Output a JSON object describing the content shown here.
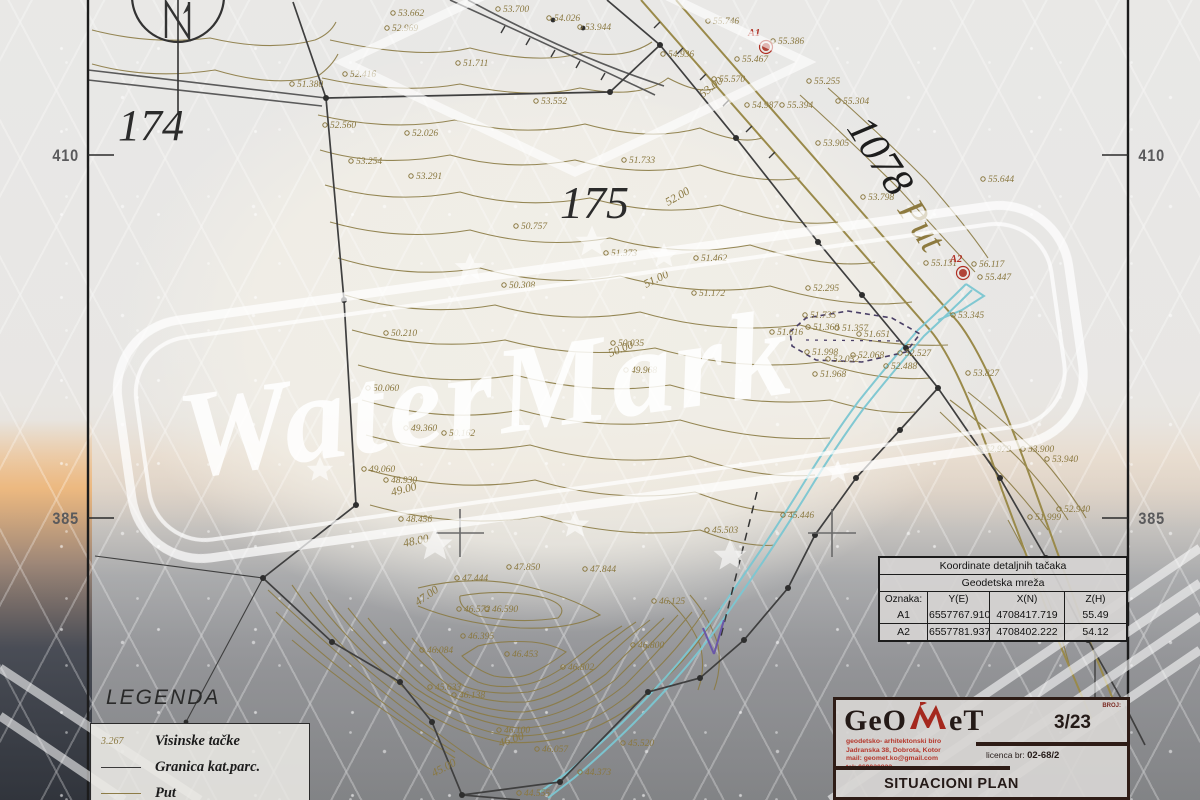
{
  "watermark": {
    "text": "WaterMark"
  },
  "colors": {
    "olive": "#8d7c46",
    "boundary": "#3f3f3f",
    "stream": "#7cc7d2",
    "purple": "#5a4a7a",
    "red": "#b03024",
    "logo_red": "#a5281e"
  },
  "frame": {
    "edge_labels": [
      {
        "text": "410",
        "x": 50,
        "y": 146
      },
      {
        "text": "385",
        "x": 50,
        "y": 509
      },
      {
        "text": "410",
        "x": 1136,
        "y": 146
      },
      {
        "text": "385",
        "x": 1136,
        "y": 509
      }
    ]
  },
  "map": {
    "area_labels": [
      {
        "text": "174",
        "x": 118,
        "y": 140,
        "size": 44,
        "rot": 0,
        "color": "#2b2b2b"
      },
      {
        "text": "175",
        "x": 560,
        "y": 218,
        "size": 46,
        "rot": 0,
        "color": "#2b2b2b"
      },
      {
        "text": "1078",
        "x": 846,
        "y": 128,
        "size": 42,
        "rot": 57,
        "color": "#1d1d1d"
      },
      {
        "text": "Put",
        "x": 897,
        "y": 210,
        "size": 38,
        "rot": 57,
        "color": "#8d7a3f"
      }
    ],
    "control_points": [
      {
        "name": "A1",
        "x": 766,
        "y": 47,
        "tx": 748,
        "ty": 36
      },
      {
        "name": "A2",
        "x": 963,
        "y": 273,
        "tx": 950,
        "ty": 262
      }
    ],
    "contour_labels": [
      {
        "v": "53.00",
        "x": 703,
        "y": 98,
        "r": -38
      },
      {
        "v": "52.00",
        "x": 668,
        "y": 206,
        "r": -30
      },
      {
        "v": "51.00",
        "x": 646,
        "y": 288,
        "r": -26
      },
      {
        "v": "50.00",
        "x": 610,
        "y": 357,
        "r": -22
      },
      {
        "v": "49.00",
        "x": 392,
        "y": 496,
        "r": -14
      },
      {
        "v": "48.00",
        "x": 404,
        "y": 547,
        "r": -12
      },
      {
        "v": "47.00",
        "x": 418,
        "y": 606,
        "r": -35
      },
      {
        "v": "46.00",
        "x": 500,
        "y": 747,
        "r": -18
      },
      {
        "v": "45.00",
        "x": 434,
        "y": 777,
        "r": -28
      }
    ],
    "spot_heights": [
      {
        "v": "53.662",
        "x": 398,
        "y": 16
      },
      {
        "v": "52.969",
        "x": 392,
        "y": 31
      },
      {
        "v": "53.700",
        "x": 503,
        "y": 12
      },
      {
        "v": "54.026",
        "x": 554,
        "y": 21
      },
      {
        "v": "53.944",
        "x": 585,
        "y": 30
      },
      {
        "v": "54.936",
        "x": 668,
        "y": 57
      },
      {
        "v": "55.746",
        "x": 713,
        "y": 24
      },
      {
        "v": "55.570",
        "x": 719,
        "y": 82
      },
      {
        "v": "55.467",
        "x": 742,
        "y": 62
      },
      {
        "v": "55.386",
        "x": 778,
        "y": 44
      },
      {
        "v": "55.255",
        "x": 814,
        "y": 84
      },
      {
        "v": "55.394",
        "x": 787,
        "y": 108
      },
      {
        "v": "54.987",
        "x": 752,
        "y": 108
      },
      {
        "v": "55.304",
        "x": 843,
        "y": 104
      },
      {
        "v": "53.905",
        "x": 823,
        "y": 146
      },
      {
        "v": "53.798",
        "x": 868,
        "y": 200
      },
      {
        "v": "55.644",
        "x": 988,
        "y": 182
      },
      {
        "v": "51.380",
        "x": 297,
        "y": 87
      },
      {
        "v": "52.416",
        "x": 350,
        "y": 77
      },
      {
        "v": "51.711",
        "x": 463,
        "y": 66
      },
      {
        "v": "53.552",
        "x": 541,
        "y": 104
      },
      {
        "v": "52.560",
        "x": 330,
        "y": 128
      },
      {
        "v": "52.026",
        "x": 412,
        "y": 136
      },
      {
        "v": "53.254",
        "x": 356,
        "y": 164
      },
      {
        "v": "53.291",
        "x": 416,
        "y": 179
      },
      {
        "v": "51.733",
        "x": 629,
        "y": 163
      },
      {
        "v": "50.757",
        "x": 521,
        "y": 229
      },
      {
        "v": "51.373",
        "x": 611,
        "y": 256
      },
      {
        "v": "51.462",
        "x": 701,
        "y": 261
      },
      {
        "v": "50.308",
        "x": 509,
        "y": 288
      },
      {
        "v": "51.172",
        "x": 699,
        "y": 296
      },
      {
        "v": "50.210",
        "x": 391,
        "y": 336
      },
      {
        "v": "50.035",
        "x": 618,
        "y": 346
      },
      {
        "v": "49.968",
        "x": 631,
        "y": 373
      },
      {
        "v": "50.060",
        "x": 373,
        "y": 391
      },
      {
        "v": "50.162",
        "x": 449,
        "y": 436
      },
      {
        "v": "49.360",
        "x": 411,
        "y": 431
      },
      {
        "v": "49.060",
        "x": 369,
        "y": 472
      },
      {
        "v": "48.930",
        "x": 391,
        "y": 483
      },
      {
        "v": "48.456",
        "x": 406,
        "y": 522
      },
      {
        "v": "52.295",
        "x": 813,
        "y": 291
      },
      {
        "v": "51.616",
        "x": 777,
        "y": 335
      },
      {
        "v": "51.735",
        "x": 810,
        "y": 318
      },
      {
        "v": "51.360",
        "x": 813,
        "y": 330
      },
      {
        "v": "51.357",
        "x": 842,
        "y": 331
      },
      {
        "v": "51.651",
        "x": 864,
        "y": 337
      },
      {
        "v": "51.998",
        "x": 812,
        "y": 355
      },
      {
        "v": "52.052",
        "x": 833,
        "y": 362
      },
      {
        "v": "52.068",
        "x": 858,
        "y": 358
      },
      {
        "v": "51.968",
        "x": 820,
        "y": 377
      },
      {
        "v": "52.527",
        "x": 905,
        "y": 356
      },
      {
        "v": "52.488",
        "x": 891,
        "y": 369
      },
      {
        "v": "55.131",
        "x": 931,
        "y": 266
      },
      {
        "v": "56.117",
        "x": 979,
        "y": 267
      },
      {
        "v": "55.447",
        "x": 985,
        "y": 280
      },
      {
        "v": "53.345",
        "x": 958,
        "y": 318
      },
      {
        "v": "53.827",
        "x": 973,
        "y": 376
      },
      {
        "v": "52.979",
        "x": 985,
        "y": 452
      },
      {
        "v": "53.900",
        "x": 1028,
        "y": 452
      },
      {
        "v": "53.940",
        "x": 1052,
        "y": 462
      },
      {
        "v": "51.999",
        "x": 1035,
        "y": 520
      },
      {
        "v": "52.940",
        "x": 1064,
        "y": 512
      },
      {
        "v": "45.446",
        "x": 788,
        "y": 518
      },
      {
        "v": "45.503",
        "x": 712,
        "y": 533
      },
      {
        "v": "47.850",
        "x": 514,
        "y": 570
      },
      {
        "v": "47.844",
        "x": 590,
        "y": 572
      },
      {
        "v": "47.444",
        "x": 462,
        "y": 581
      },
      {
        "v": "46.572",
        "x": 464,
        "y": 612
      },
      {
        "v": "46.590",
        "x": 492,
        "y": 612
      },
      {
        "v": "46.125",
        "x": 659,
        "y": 604
      },
      {
        "v": "46.395",
        "x": 468,
        "y": 639
      },
      {
        "v": "46.084",
        "x": 427,
        "y": 653
      },
      {
        "v": "46.453",
        "x": 512,
        "y": 657
      },
      {
        "v": "46.802",
        "x": 568,
        "y": 670
      },
      {
        "v": "46.800",
        "x": 638,
        "y": 648
      },
      {
        "v": "45.633",
        "x": 435,
        "y": 690
      },
      {
        "v": "46.138",
        "x": 459,
        "y": 698
      },
      {
        "v": "46.100",
        "x": 504,
        "y": 733
      },
      {
        "v": "46.057",
        "x": 542,
        "y": 752
      },
      {
        "v": "45.520",
        "x": 628,
        "y": 746
      },
      {
        "v": "44.373",
        "x": 585,
        "y": 775
      },
      {
        "v": "44.555",
        "x": 524,
        "y": 796
      }
    ]
  },
  "legend": {
    "title": "LEGENDA",
    "items": [
      {
        "key_type": "text",
        "key": "3.267",
        "label": "Visinske tačke"
      },
      {
        "key_type": "dark-line",
        "key": "",
        "label": "Granica kat.parc."
      },
      {
        "key_type": "olive-line",
        "key": "",
        "label": "Put"
      }
    ]
  },
  "coord_table": {
    "title": "Koordinate detaljnih tačaka",
    "subtitle": "Geodetska mreža",
    "columns": [
      "Oznaka:",
      "Y(E)",
      "X(N)",
      "Z(H)"
    ],
    "rows": [
      [
        "A1",
        "6557767.910",
        "4708417.719",
        "55.49"
      ],
      [
        "A2",
        "6557781.937",
        "4708402.222",
        "54.12"
      ]
    ]
  },
  "title_block": {
    "logo_pre": "GeO",
    "logo_post": "eT",
    "firm_lines": [
      "geodetsko- arhitektonski biro",
      "Jadranska 38, Dobrota, Kotor",
      "mail: geomet.ko@gmail.com",
      "tel: 069020823"
    ],
    "broj_label": "BROJ:",
    "number": "3/23",
    "licence_label": "licenca br:",
    "licence_value": "02-68/2",
    "title": "SITUACIONI PLAN"
  }
}
